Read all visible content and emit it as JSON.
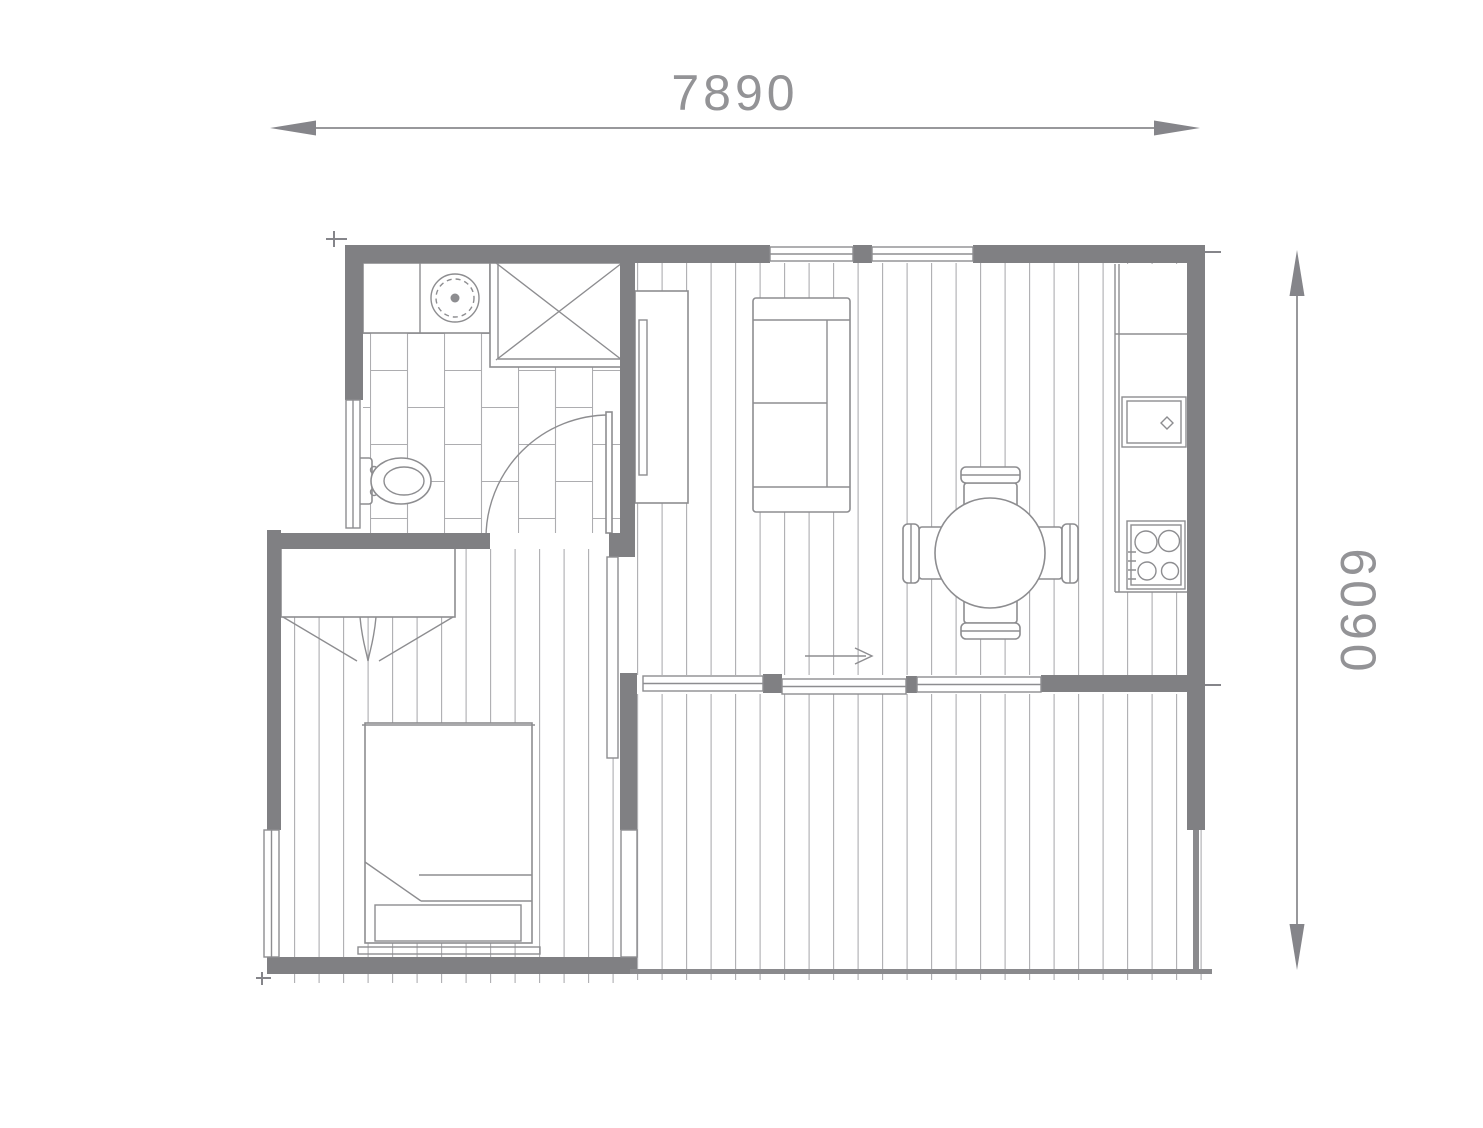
{
  "plan": {
    "title": "floor-plan",
    "width_label": "7890",
    "height_label": "6090"
  },
  "colors": {
    "background": "#ffffff",
    "wall": "#808083",
    "fixture_line": "#8d8d90",
    "floor_line": "#adadb0",
    "dimension_text": "#939396",
    "dimension_line": "#98989b"
  },
  "icons": [
    "washing-machine-icon",
    "shower-icon",
    "toilet-icon",
    "bathroom-door-icon",
    "hall-wardrobe-icon",
    "bedroom-wardrobe-icon",
    "sofa-icon",
    "dining-table-icon",
    "dining-chair-icon",
    "kitchen-counter-icon",
    "kitchen-sink-icon",
    "cooktop-icon",
    "double-bed-icon",
    "window-icon",
    "sliding-glass-door-icon",
    "entry-arrow-icon"
  ]
}
